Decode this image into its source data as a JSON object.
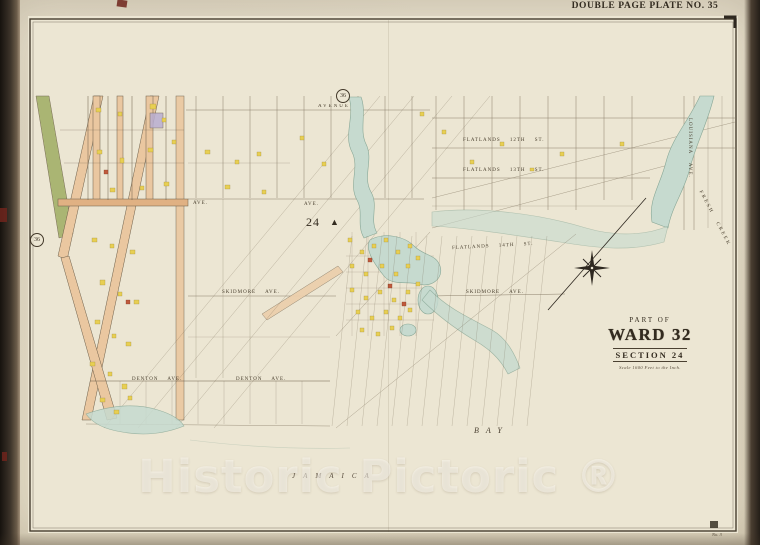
{
  "page": {
    "plate_title": "DOUBLE PAGE PLATE NO. 35",
    "corner_note": "No. 3",
    "watermark": "Historic Pictoric ®"
  },
  "map": {
    "adjacent_plate_top": "36",
    "adjacent_plate_left": "36",
    "district_number": "24",
    "icons": {
      "survey_triangle": "▲"
    },
    "title_block": {
      "part_of": "PART OF",
      "ward": "WARD 32",
      "section": "SECTION 24",
      "scale": "Scale 1600 Feet to the Inch."
    },
    "labels": {
      "avenue_top": "AVENUE",
      "ave_1": "AVE.",
      "ave_2": "AVE.",
      "flatlands_12th": "FLATLANDS 12TH ST.",
      "flatlands_13th": "FLATLANDS 13TH ST.",
      "flatlands_14th": "FLATLANDS 14TH ST.",
      "skidmore_w": "SKIDMORE AVE.",
      "skidmore_e": "SKIDMORE AVE.",
      "denton_w": "DENTON AVE.",
      "denton_e": "DENTON AVE.",
      "louisiana": "LOUISIANA AVE.",
      "fresh_creek": "FRESH CREEK",
      "jamaica": "JAMAICA",
      "bay": "BAY"
    },
    "colors": {
      "paper": "#ece6d3",
      "street_pink": "#eac7a0",
      "building_yellow": "#e8cf52",
      "building_red": "#bf5a3c",
      "rail_green": "#a3b069",
      "water": "#c6dacf",
      "line_sepia": "#5a4d3a"
    }
  }
}
